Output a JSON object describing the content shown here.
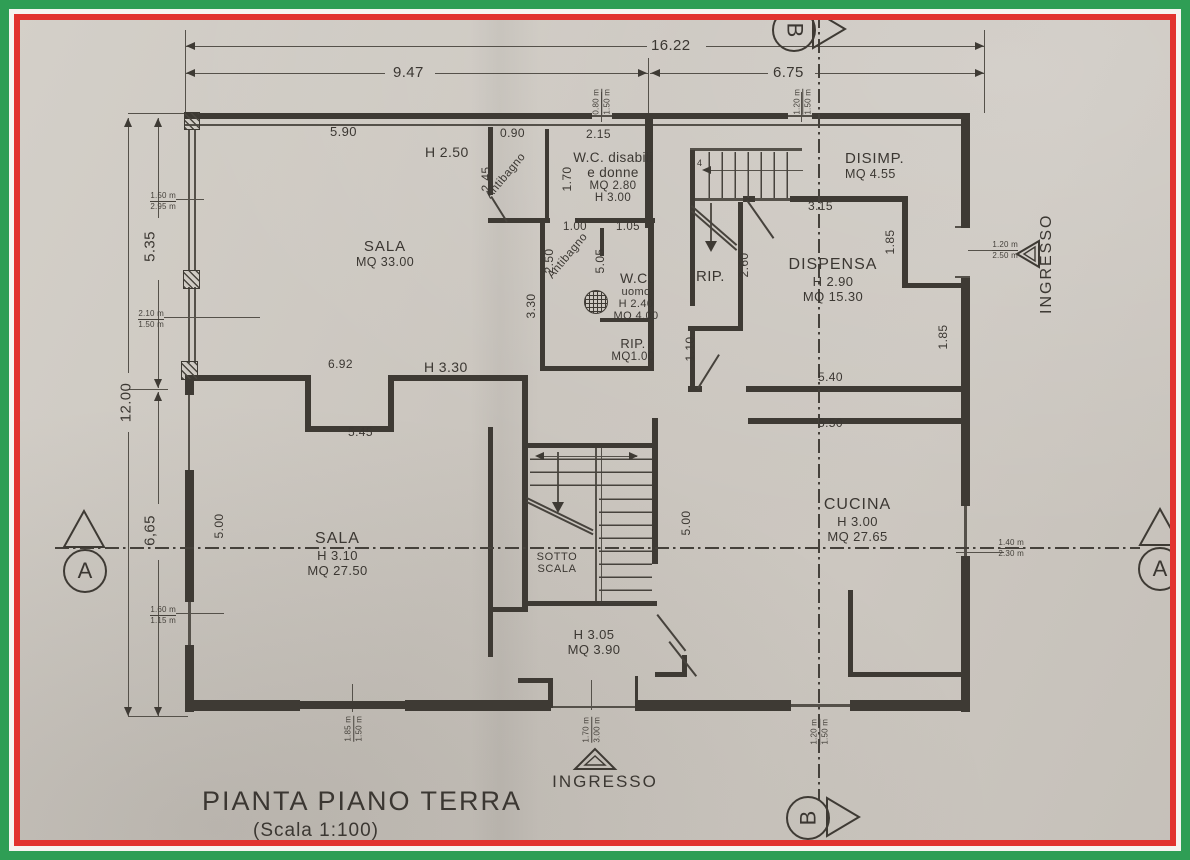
{
  "frame": {
    "green": "#2f9e55",
    "white": "#f6f4f0",
    "red": "#e2332e"
  },
  "paper": {
    "color": "#cbc6bf"
  },
  "title": {
    "text": "PIANTA PIANO TERRA",
    "scale": "(Scala 1:100)"
  },
  "dimensions": {
    "top": {
      "total": "16.22",
      "left": "9.47",
      "right": "6.75"
    },
    "left": {
      "upper": "5.35",
      "total": "12.00",
      "lower": "6,65"
    }
  },
  "rooms": {
    "sala_top": {
      "name": "SALA",
      "area": "MQ 33.00",
      "width": "5.90",
      "height": "H 2.50"
    },
    "antibagno_top": {
      "name": "Antibagno",
      "width": "0.90",
      "depth": "2.45",
      "inner": "1.70"
    },
    "wc_disabili": {
      "l1": "W.C. disabili",
      "l2": "e donne",
      "l3": "MQ 2.80",
      "l4": "H 3.00",
      "width": "2.15"
    },
    "antibagno_mid": {
      "name": "Antibagno",
      "w1": "1.00",
      "w2": "1.05",
      "d1": "2.50",
      "d2": "5.05",
      "d3": "3.30"
    },
    "wc_uomo": {
      "l1": "W.C.",
      "l2": "uomo",
      "l3": "H 2.40",
      "l4": "MQ 4.00"
    },
    "rip_small": {
      "name": "RIP.",
      "area": "MQ1.00"
    },
    "rip_right": {
      "name": "RIP.",
      "d1": "2.60",
      "d2": "1.10"
    },
    "dispensa": {
      "name": "DISPENSA",
      "height": "H 2.90",
      "area": "MQ 15.30",
      "w1": "3.15",
      "d1": "1.85",
      "d2": "1.85",
      "w2": "5.40",
      "w3": "5.50"
    },
    "disimp": {
      "name": "DISIMP.",
      "area": "MQ 4.55"
    },
    "cucina": {
      "name": "CUCINA",
      "height": "H 3.00",
      "area": "MQ 27.65"
    },
    "sala_bottom": {
      "name": "SALA",
      "height": "H 3.10",
      "area": "MQ 27.50",
      "w1": "6.92",
      "h2": "H 3.30",
      "w2": "5.45",
      "d1": "5.00"
    },
    "sotto_scala": {
      "l1": "SOTTO",
      "l2": "SCALA",
      "d1": "5.00"
    },
    "under_stair": {
      "height": "H 3.05",
      "area": "MQ 3.90"
    }
  },
  "stairs": {
    "upper_step_note": "4"
  },
  "entrances": {
    "right": "INGRESSO",
    "bottom": "INGRESSO"
  },
  "sections": {
    "a": "A",
    "b": "B"
  },
  "openings": {
    "left_top": {
      "a": "1.50 m",
      "b": "2.95 m"
    },
    "left_mid": {
      "a": "2.10 m",
      "b": "1.50 m"
    },
    "left_bottom": {
      "a": "1.60 m",
      "b": "1.15 m"
    },
    "top_center": {
      "a": "0.80 m",
      "b": "1.50 m"
    },
    "top_right": {
      "a": "1.20 m",
      "b": "1.50 m"
    },
    "right_entry": {
      "a": "1.20 m",
      "b": "2.50 m"
    },
    "right_kitchen": {
      "a": "1.40 m",
      "b": "2.30 m"
    },
    "bottom_left": {
      "a": "1.85 m",
      "b": "1.50 m"
    },
    "bottom_entry": {
      "a": "1.70 m",
      "b": "3.00 m"
    },
    "bottom_right": {
      "a": "1.20 m",
      "b": "1.50 m"
    }
  }
}
